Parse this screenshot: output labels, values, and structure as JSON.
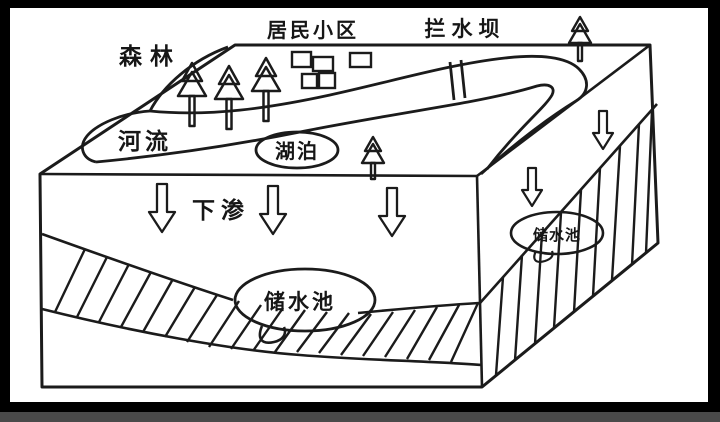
{
  "figure": {
    "type": "hydrology-block-diagram",
    "labels": {
      "forest": "森林",
      "residential_area": "居民小区",
      "dam": "拦水坝",
      "river": "河流",
      "lake": "湖泊",
      "infiltration": "下渗",
      "reservoir_front": "储水池",
      "reservoir_right": "储水池"
    },
    "colors": {
      "ink": "#1b1b1b",
      "paper": "#ffffff",
      "frame": "#000000"
    },
    "element_counts": {
      "forest_trees": 3,
      "single_trees": 2,
      "houses": 5,
      "infiltration_arrows_front": 3,
      "infiltration_arrows_right": 2,
      "dam_lines": 2
    }
  }
}
